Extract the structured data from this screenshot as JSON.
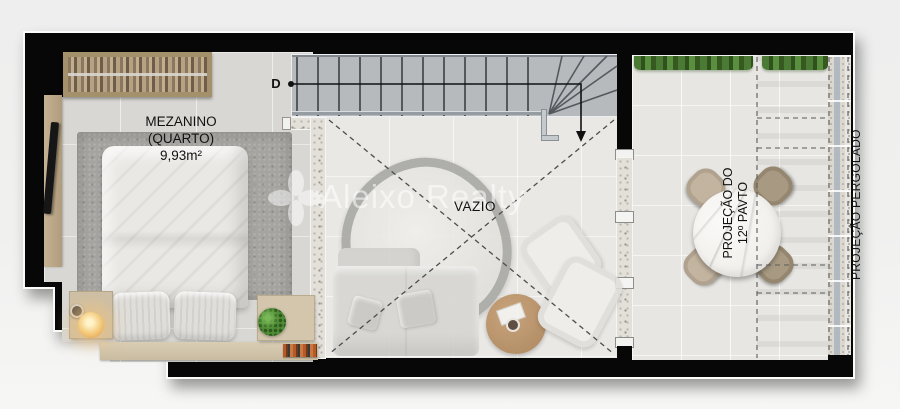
{
  "rooms": {
    "mezzanine": {
      "title": "MEZANINO",
      "subtitle": "(QUARTO)",
      "area": "9,93m²"
    },
    "void": {
      "label": "VAZIO"
    },
    "stairs": {
      "direction_label": "D"
    }
  },
  "projections": {
    "floor_line1": "PROJEÇÃO DO",
    "floor_line2": "12º PAVTO",
    "pergola": "PROJEÇÃO PERGOLADO"
  },
  "watermark": {
    "brand": "Aleixo Realty"
  },
  "colors": {
    "wall": "#070707",
    "outline": "#fbfbfa",
    "bedroom_floor": "#d8d7d3",
    "stair_floor": "#b6babd",
    "void_floor": "#e9e8e5",
    "terrace_floor": "#e7e6e2",
    "rug": "#a5a4a0",
    "wood": "#c9bca1",
    "plant_green": "#4a7a33",
    "lamp_glow": "#f3c878",
    "glass": "#b0bac3",
    "background": "#f0f0ef"
  }
}
